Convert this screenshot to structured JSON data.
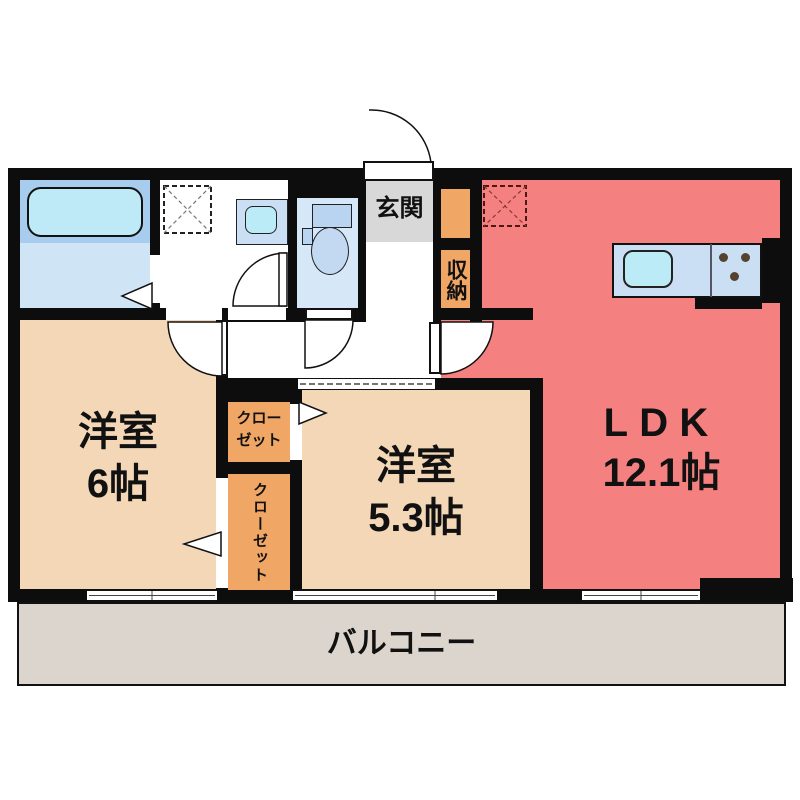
{
  "plan": {
    "type": "apartment-floor-plan",
    "rooms": {
      "ldk": {
        "label": "LDK",
        "size": "12.1帖"
      },
      "bedroom_6": {
        "label": "洋室",
        "size": "6帖"
      },
      "bedroom_53": {
        "label": "洋室",
        "size": "5.3帖"
      },
      "entrance": {
        "label": "玄関"
      },
      "storage": {
        "label": "収納"
      },
      "closet_upper": {
        "line1": "クロー",
        "line2": "ゼット"
      },
      "closet_lower": {
        "label": "クローゼット"
      },
      "balcony": {
        "label": "バルコニー"
      }
    },
    "fixtures": [
      "bathtub",
      "washing-machine-space",
      "vanity-sink",
      "toilet",
      "kitchen-sink",
      "gas-stove",
      "refrigerator-space"
    ],
    "colors": {
      "wall": "#0d0d0d",
      "ldk": "#F48080",
      "bedroom": "#F3D7B7",
      "closet": "#F0A665",
      "balcony": "#DBD5CD",
      "entrance_floor": "#D8D8D8",
      "bath_room": "#CFE4F5",
      "bath_tub": "#BEEAF7",
      "toilet_room": "#D6E8F8",
      "fixture_blue": "#B8D4F0",
      "kitchen_counter": "#CADFF3",
      "kitchen_sink": "#BCEBF8"
    }
  }
}
